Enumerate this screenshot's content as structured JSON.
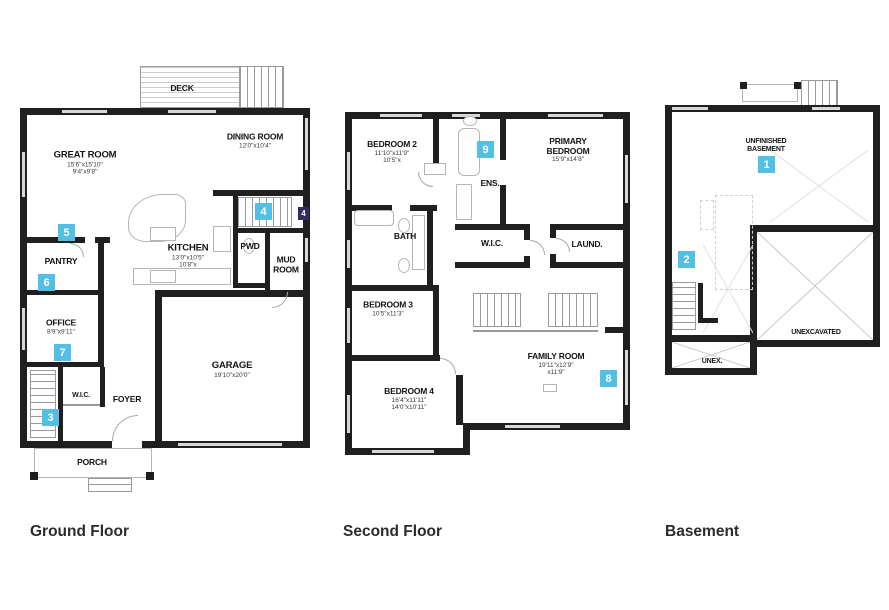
{
  "colors": {
    "badge_blue": "#53bfe4",
    "badge_dark_purple": "#352a63",
    "wall_black": "#1f1f1f",
    "background": "#ffffff"
  },
  "floors": [
    {
      "name": "Ground Floor",
      "rooms": {
        "deck": {
          "name": "DECK"
        },
        "great_room": {
          "name": "GREAT ROOM",
          "dim1": "15'6\"x15'10\"",
          "dim2": "9'4\"x9'8\""
        },
        "dining_room": {
          "name": "DINING ROOM",
          "dim1": "12'0\"x10'4\""
        },
        "kitchen": {
          "name": "KITCHEN",
          "dim1": "13'0\"x10'5\"",
          "dim2": "10'8\"x"
        },
        "pantry": {
          "name": "PANTRY"
        },
        "pwd": {
          "name": "PWD"
        },
        "mud_room": {
          "name": "MUD ROOM"
        },
        "office": {
          "name": "OFFICE",
          "dim1": "8'9\"x9'11\""
        },
        "wic": {
          "name": "W.I.C."
        },
        "foyer": {
          "name": "FOYER"
        },
        "garage": {
          "name": "GARAGE",
          "dim1": "19'10\"x20'0\""
        },
        "porch": {
          "name": "PORCH"
        }
      },
      "badges": {
        "b3": "3",
        "b4": "4",
        "b4d": "4",
        "b5": "5",
        "b6": "6",
        "b7": "7"
      }
    },
    {
      "name": "Second Floor",
      "rooms": {
        "bedroom2": {
          "name": "BEDROOM 2",
          "dim1": "11'10\"x11'9\"",
          "dim2": "10'5\"x"
        },
        "ens": {
          "name": "ENS."
        },
        "primary": {
          "name": "PRIMARY BEDROOM",
          "dim1": "15'9\"x14'8\""
        },
        "bath": {
          "name": "BATH"
        },
        "wic": {
          "name": "W.I.C."
        },
        "laund": {
          "name": "LAUND."
        },
        "bedroom3": {
          "name": "BEDROOM 3",
          "dim1": "10'5\"x11'3\""
        },
        "bedroom4": {
          "name": "BEDROOM 4",
          "dim1": "16'4\"x11'11\"",
          "dim2": "14'0\"x10'11\""
        },
        "family_room": {
          "name": "FAMILY ROOM",
          "dim1": "19'11\"x12'9\"",
          "dim2": "x11'9\""
        }
      },
      "badges": {
        "b8": "8",
        "b9": "9"
      }
    },
    {
      "name": "Basement",
      "rooms": {
        "unfinished": {
          "name": "UNFINISHED BASEMENT"
        },
        "unexcavated": {
          "name": "UNEXCAVATED"
        },
        "unex": {
          "name": "UNEX."
        }
      },
      "badges": {
        "b1": "1",
        "b2": "2"
      }
    }
  ]
}
